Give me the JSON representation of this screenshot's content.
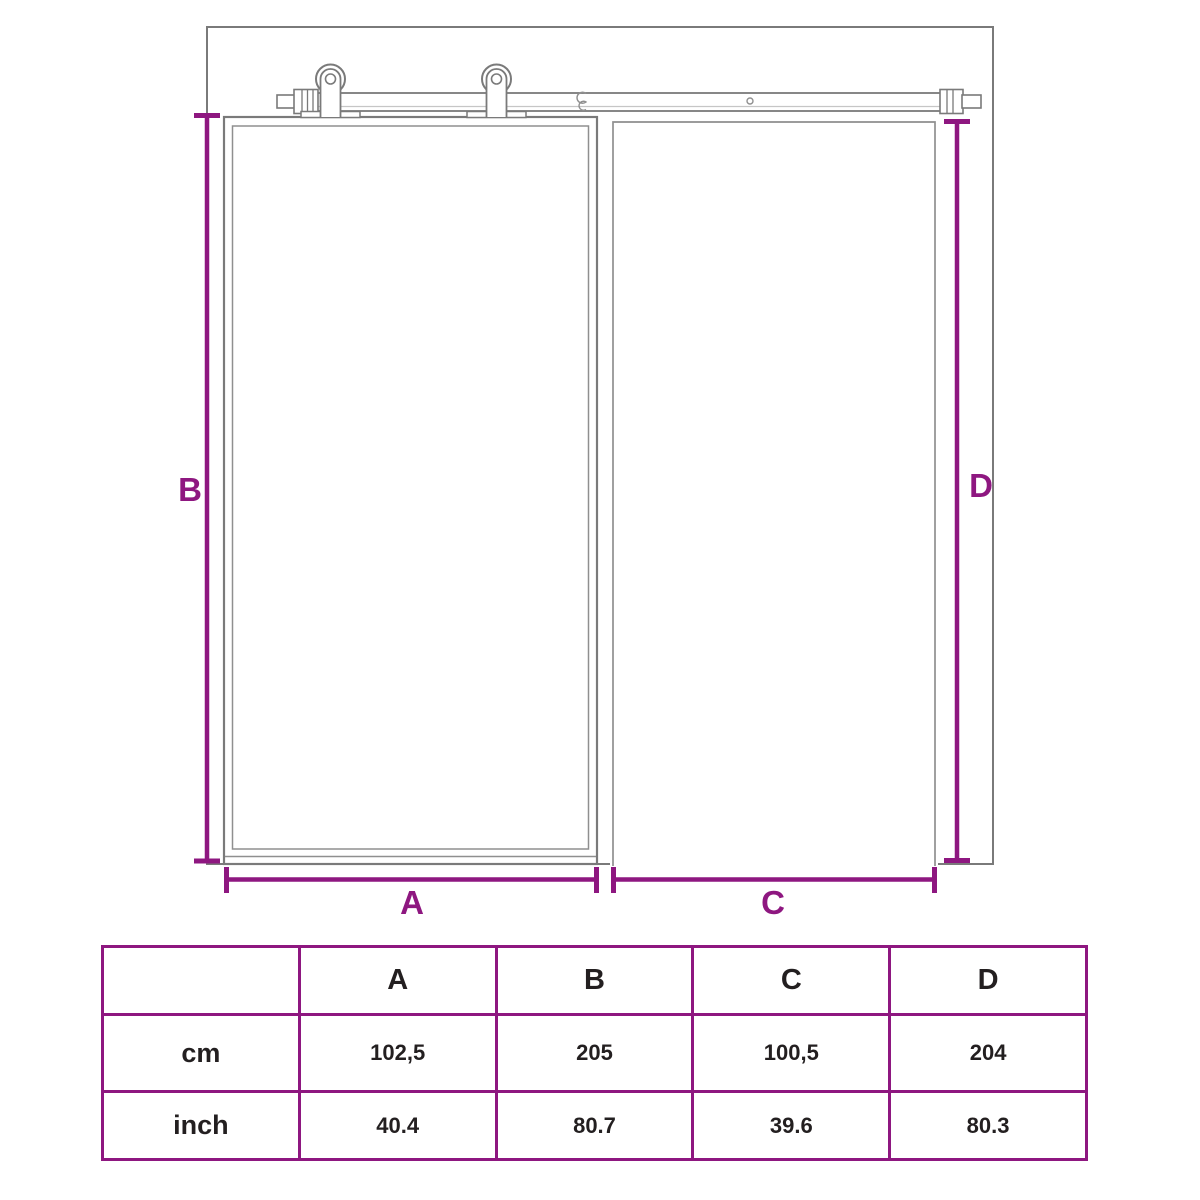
{
  "colors": {
    "accent_purple": "#8e1780",
    "line_gray": "#7a7a7a",
    "text_dark": "#231f20",
    "background": "#ffffff"
  },
  "diagram": {
    "description": "sliding-barn-door-dimension-drawing",
    "dimension_labels": {
      "a": "A",
      "b": "B",
      "c": "C",
      "d": "D"
    }
  },
  "table": {
    "header": [
      "",
      "A",
      "B",
      "C",
      "D"
    ],
    "rows": [
      {
        "label": "cm",
        "values": [
          "102,5",
          "205",
          "100,5",
          "204"
        ]
      },
      {
        "label": "inch",
        "values": [
          "40.4",
          "80.7",
          "39.6",
          "80.3"
        ]
      }
    ]
  }
}
